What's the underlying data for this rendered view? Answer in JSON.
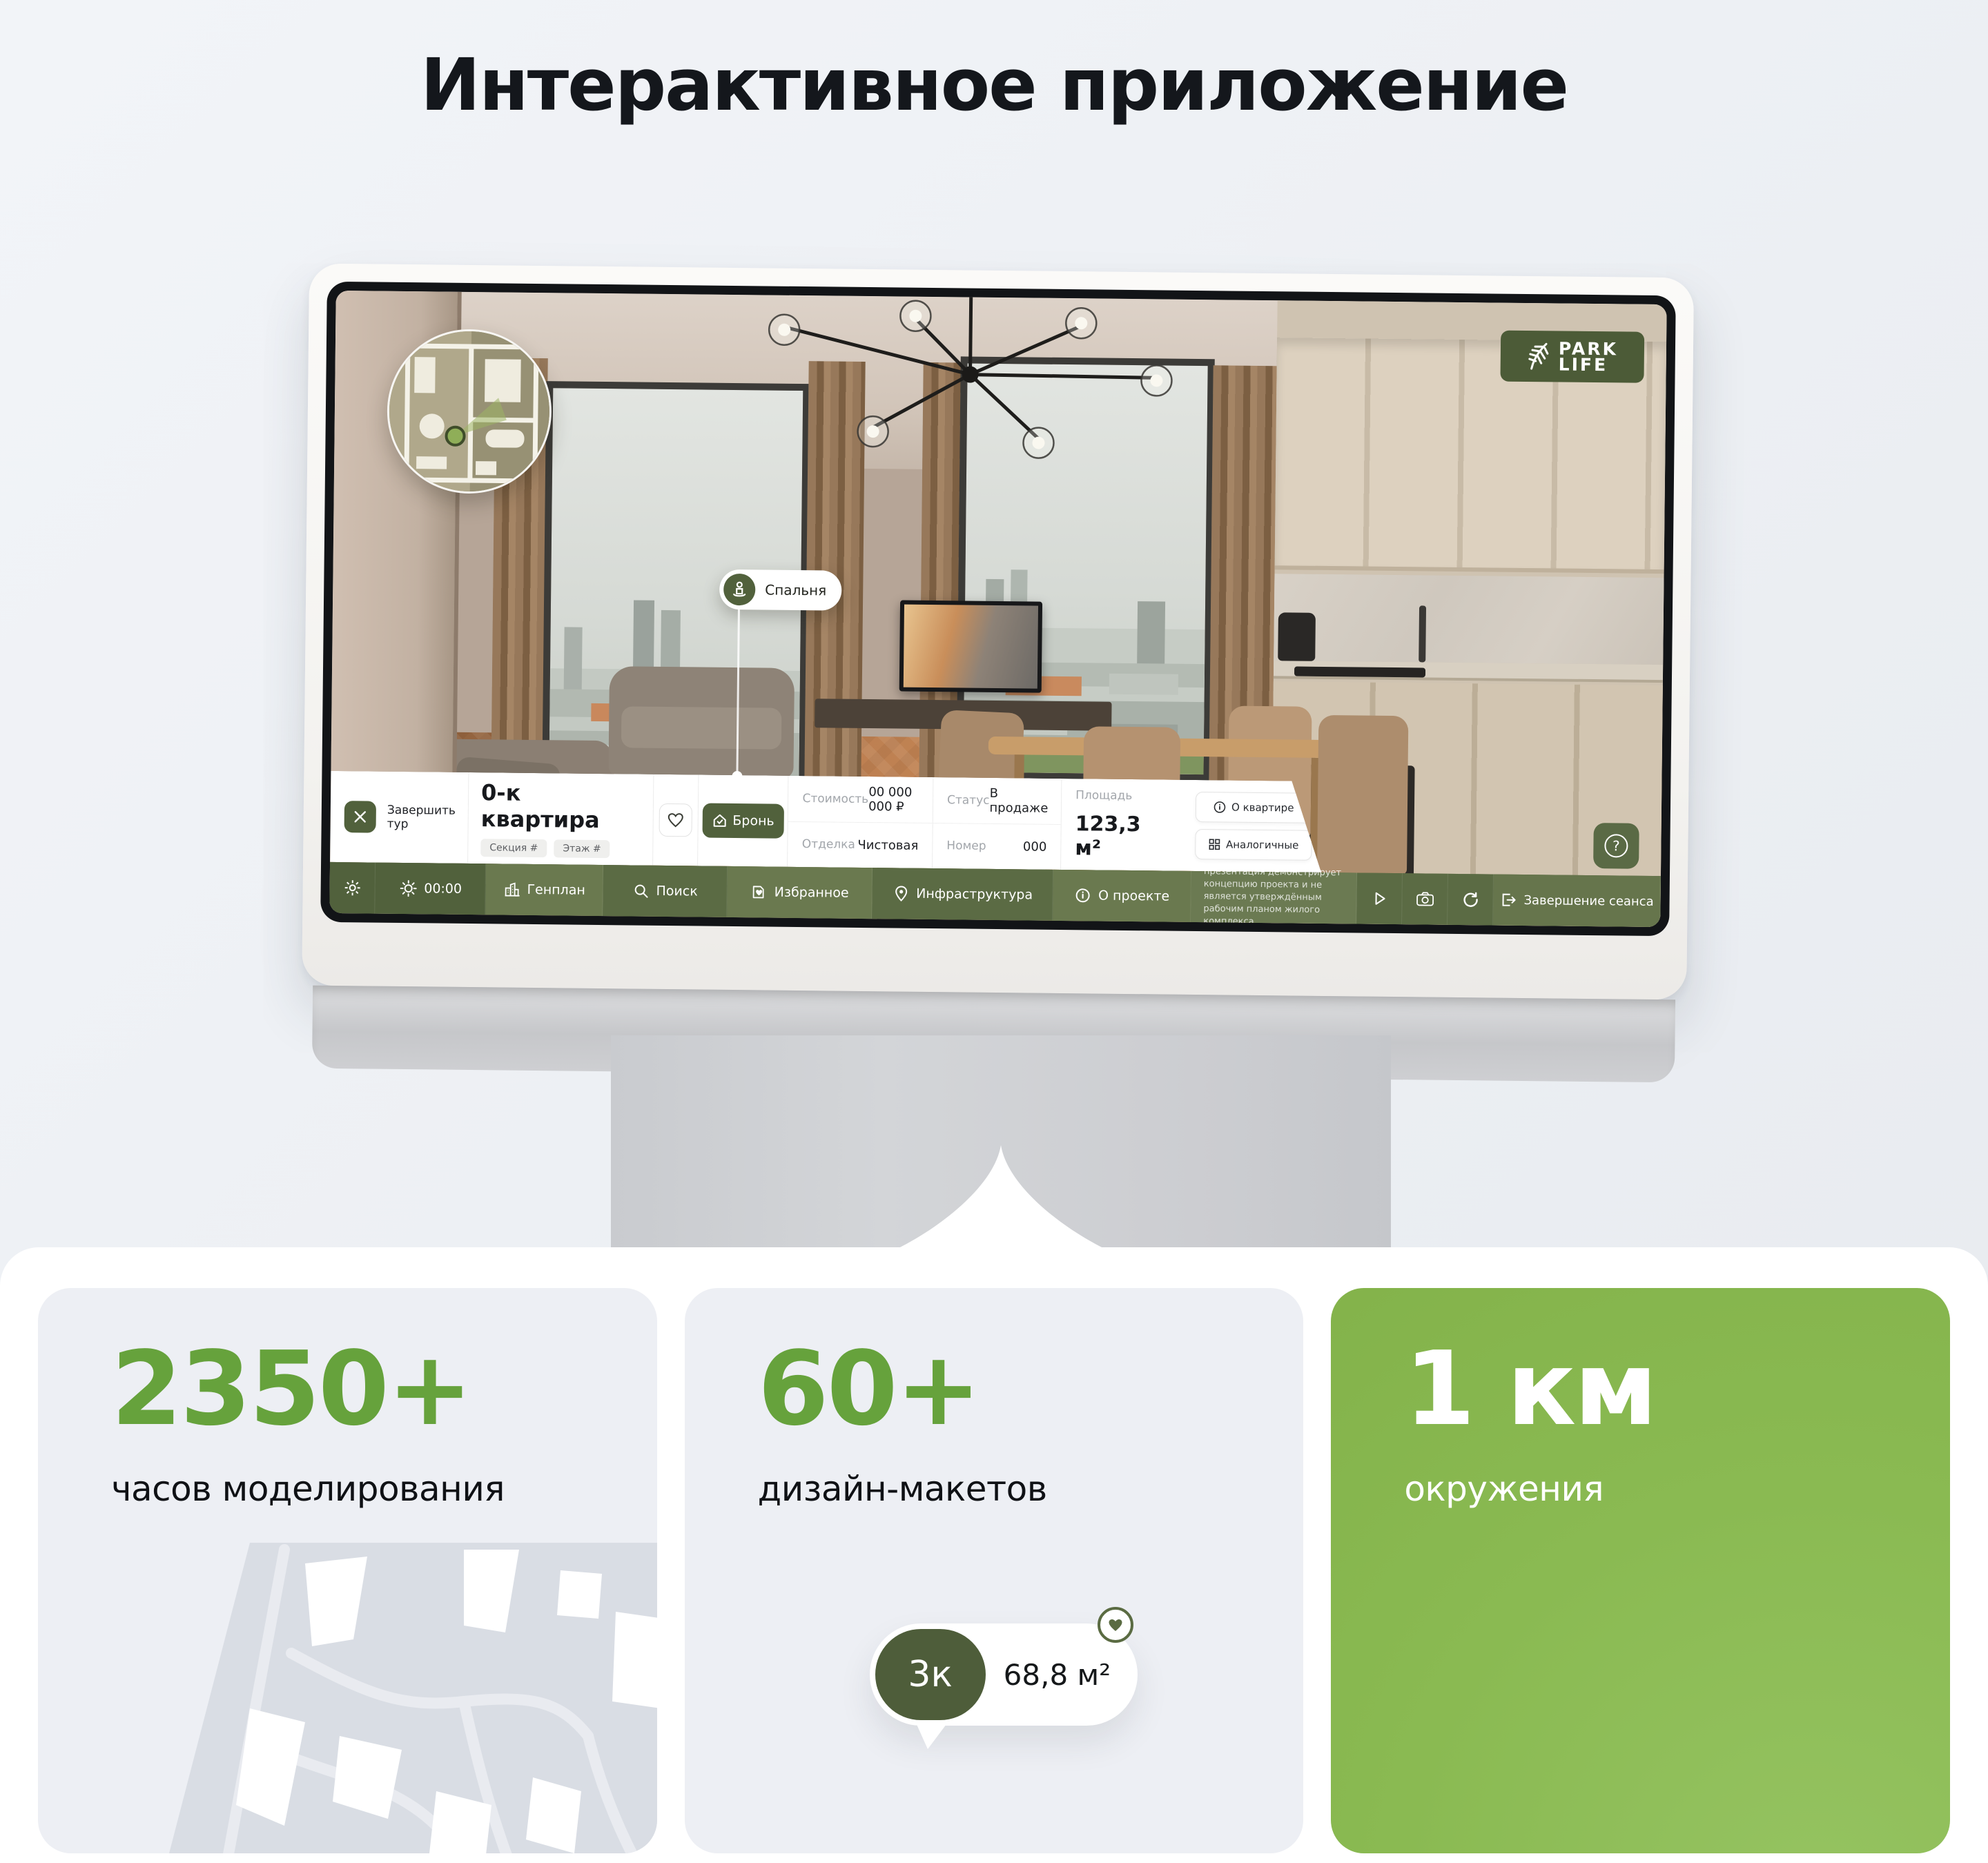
{
  "page": {
    "title": "Интерактивное приложение"
  },
  "colors": {
    "accent_green": "#66A23C",
    "dark_green": "#4E5D3A",
    "nav_green": "#57673F",
    "card_green": "#8ABA52",
    "card_gray": "#EDEFF4"
  },
  "screen": {
    "logo": {
      "line1": "PARK",
      "line2": "LIFE"
    },
    "minimap": {
      "description": "floor-plan-minimap"
    },
    "room_pin": {
      "label": "Спальня"
    },
    "info_bar": {
      "finish_tour": "Завершить тур",
      "apartment_title": "0-к квартира",
      "badges": [
        "Секция #",
        "Этаж #"
      ],
      "reserve": "Бронь",
      "fields": [
        {
          "label": "Стоимость",
          "value": "00 000 000 ₽"
        },
        {
          "label": "Отделка",
          "value": "Чистовая"
        },
        {
          "label": "Статус",
          "value": "В продаже"
        },
        {
          "label": "Номер",
          "value": "000"
        }
      ],
      "area_label": "Площадь",
      "area_value": "123,3 м²",
      "about_apartment": "О квартире",
      "similar": "Аналогичные",
      "help": "?"
    },
    "nav_bar": {
      "time": "00:00",
      "items": [
        "Генплан",
        "Поиск",
        "Избранное",
        "Инфраструктура",
        "О проекте"
      ],
      "disclaimer": "презентация демонстрирует концепцию проекта и не является утверждённым рабочим планом жилого комплекса",
      "end_session": "Завершение сеанса"
    }
  },
  "cards": [
    {
      "value": "2350+",
      "label": "часов моделирования"
    },
    {
      "value": "60+",
      "label": "дизайн-макетов",
      "chip": {
        "rooms": "3к",
        "area": "68,8 м²",
        "favorited": "true"
      }
    },
    {
      "value": "1 км",
      "label": "окружения"
    }
  ]
}
